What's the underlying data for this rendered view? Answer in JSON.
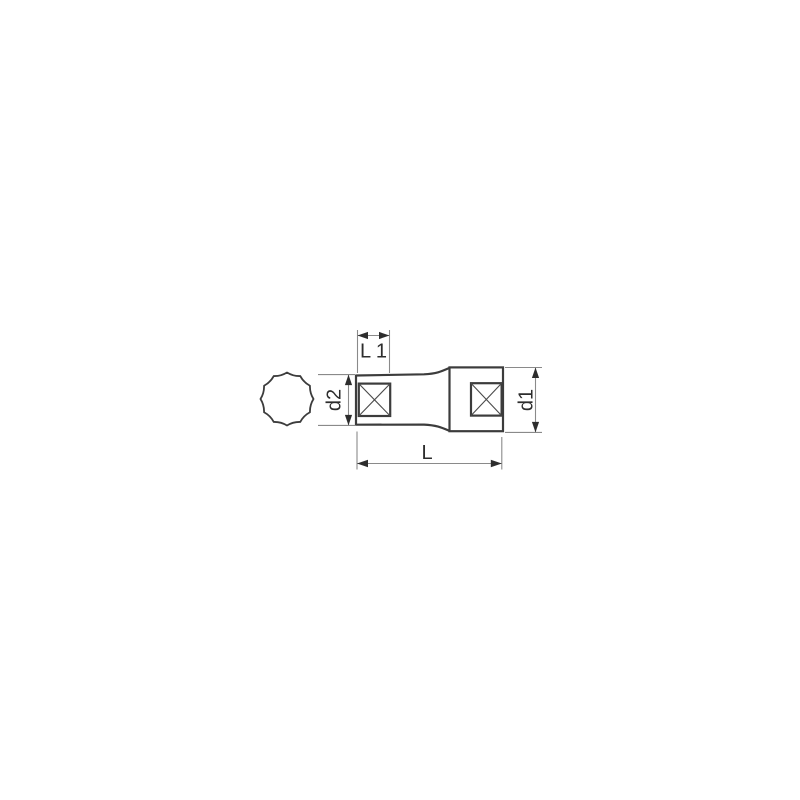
{
  "diagram": {
    "kind": "technical-drawing",
    "subject": "deep-socket-12-point",
    "labels": {
      "l1": "L 1",
      "d2": "d2",
      "d1": "d1",
      "l": "L"
    },
    "colors": {
      "background": "#ffffff",
      "outline": "#3c3c3c",
      "dimension_line": "#8a8a8a",
      "arrow": "#2d2d2d",
      "text": "#2d2d2d"
    }
  }
}
